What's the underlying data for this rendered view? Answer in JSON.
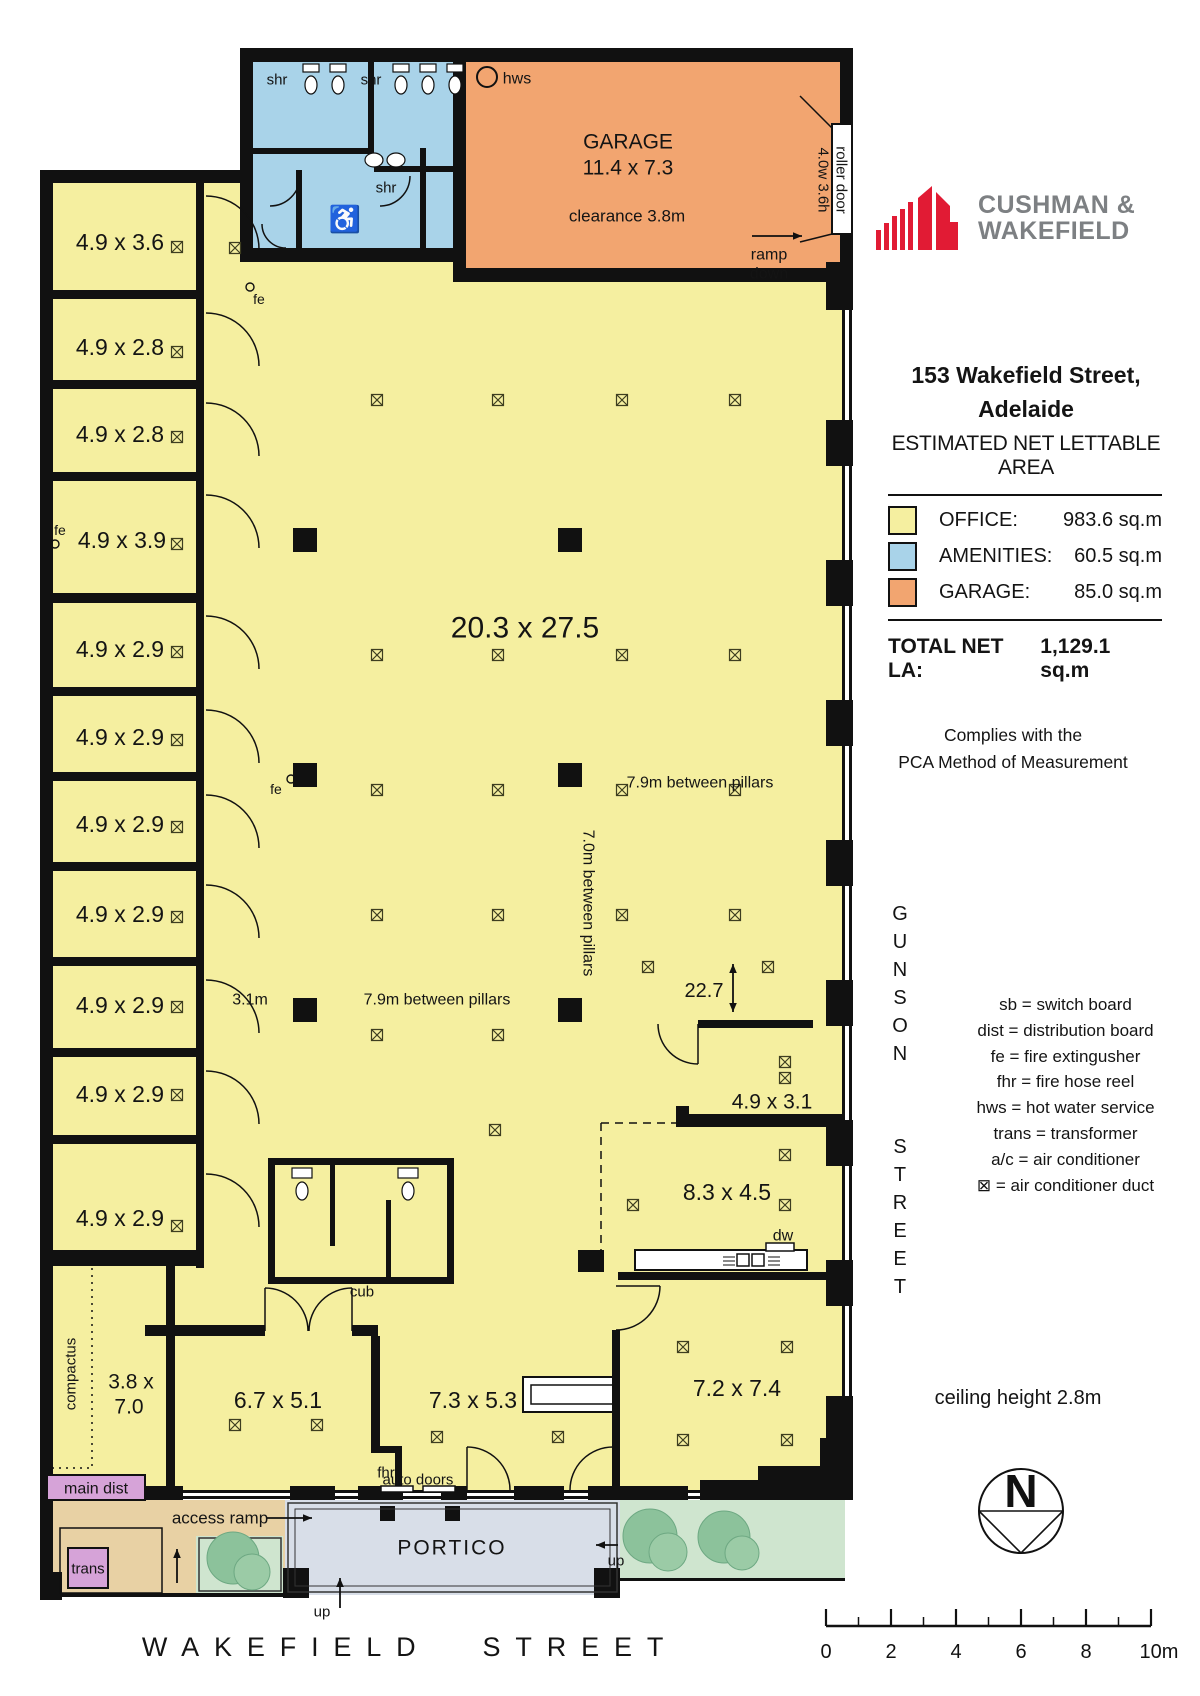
{
  "brand": {
    "line1": "CUSHMAN &",
    "line2": "WAKEFIELD",
    "red": "#e11b34",
    "gray": "#7d8083"
  },
  "panel": {
    "address1": "153 Wakefield Street,",
    "address2": "Adelaide",
    "subtitle": "ESTIMATED NET LETTABLE AREA",
    "legend": {
      "rows": [
        {
          "label": "OFFICE:",
          "value": "983.6 sq.m",
          "color": "#f5efa0"
        },
        {
          "label": "AMENITIES:",
          "value": "60.5 sq.m",
          "color": "#a9d3e9"
        },
        {
          "label": "GARAGE:",
          "value": "85.0 sq.m",
          "color": "#f2a570"
        }
      ],
      "total_label": "TOTAL NET LA:",
      "total_value": "1,129.1 sq.m"
    },
    "compliance1": "Complies with the",
    "compliance2": "PCA Method of Measurement",
    "abbreviations": [
      "sb = switch board",
      "dist = distribution board",
      "fe = fire extingusher",
      "fhr = fire hose reel",
      "hws = hot water service",
      "trans = transformer",
      "a/c = air conditioner",
      "⊠ = air conditioner duct"
    ],
    "ceiling_note": "ceiling height 2.8m",
    "north_letter": "N",
    "scalebar": {
      "labels": [
        "0",
        "2",
        "4",
        "6",
        "8",
        "10m"
      ]
    }
  },
  "streets": {
    "side1": "GUNSON",
    "side2": "STREET",
    "bottom": "WAKEFIELD STREET"
  },
  "plan": {
    "rects": [
      [
        52,
        182,
        793,
        1308,
        "#f5efa0"
      ],
      [
        252,
        60,
        201,
        195,
        "#a9d3e9"
      ],
      [
        465,
        62,
        375,
        208,
        "#f2a570"
      ],
      [
        52,
        1500,
        233,
        93,
        "#e8d1a4"
      ],
      [
        196,
        1536,
        87,
        57,
        "#cfe5cf"
      ],
      [
        285,
        1500,
        335,
        95,
        "#d8dee8"
      ],
      [
        620,
        1500,
        225,
        80,
        "#cfe5cf"
      ],
      [
        240,
        48,
        613,
        14
      ],
      [
        240,
        48,
        13,
        214
      ],
      [
        40,
        170,
        213,
        13
      ],
      [
        40,
        170,
        13,
        1427
      ],
      [
        240,
        248,
        226,
        14
      ],
      [
        453,
        48,
        13,
        234
      ],
      [
        453,
        268,
        400,
        14
      ],
      [
        196,
        182,
        8,
        1086
      ],
      [
        40,
        290,
        164,
        9
      ],
      [
        40,
        380,
        164,
        9
      ],
      [
        40,
        472,
        164,
        9
      ],
      [
        40,
        593,
        164,
        10
      ],
      [
        40,
        687,
        164,
        9
      ],
      [
        40,
        772,
        164,
        9
      ],
      [
        40,
        862,
        164,
        9
      ],
      [
        40,
        957,
        164,
        9
      ],
      [
        40,
        1048,
        164,
        9
      ],
      [
        40,
        1135,
        164,
        9
      ],
      [
        40,
        1250,
        164,
        16
      ],
      [
        166,
        1262,
        9,
        230
      ],
      [
        145,
        1325,
        120,
        11
      ],
      [
        352,
        1325,
        26,
        11
      ],
      [
        371,
        1336,
        9,
        116
      ],
      [
        371,
        1446,
        30,
        7
      ],
      [
        395,
        1446,
        7,
        46
      ],
      [
        612,
        1330,
        8,
        162
      ],
      [
        618,
        1272,
        227,
        8
      ],
      [
        578,
        1250,
        26,
        22
      ],
      [
        698,
        1020,
        115,
        8
      ],
      [
        676,
        1114,
        169,
        13
      ],
      [
        676,
        1106,
        13,
        21
      ],
      [
        268,
        1158,
        186,
        7
      ],
      [
        268,
        1277,
        186,
        7
      ],
      [
        268,
        1158,
        7,
        126
      ],
      [
        447,
        1158,
        7,
        126
      ],
      [
        330,
        1158,
        5,
        88
      ],
      [
        386,
        1200,
        5,
        84
      ],
      [
        368,
        60,
        6,
        94
      ],
      [
        252,
        148,
        116,
        6
      ],
      [
        374,
        166,
        79,
        6
      ],
      [
        296,
        170,
        6,
        85
      ],
      [
        420,
        148,
        6,
        100
      ],
      [
        840,
        62,
        13,
        64
      ],
      [
        840,
        230,
        13,
        52
      ],
      [
        842,
        262,
        3,
        1236
      ],
      [
        849,
        262,
        3,
        1236
      ],
      [
        826,
        262,
        27,
        48
      ],
      [
        826,
        420,
        27,
        46
      ],
      [
        826,
        560,
        27,
        46
      ],
      [
        826,
        700,
        27,
        46
      ],
      [
        826,
        840,
        27,
        46
      ],
      [
        826,
        980,
        27,
        46
      ],
      [
        826,
        1120,
        27,
        46
      ],
      [
        826,
        1260,
        27,
        46
      ],
      [
        826,
        1396,
        27,
        46
      ],
      [
        820,
        1438,
        33,
        62
      ],
      [
        150,
        1490,
        695,
        3
      ],
      [
        150,
        1496,
        695,
        3
      ],
      [
        145,
        1486,
        38,
        14
      ],
      [
        290,
        1486,
        45,
        14
      ],
      [
        358,
        1486,
        45,
        14
      ],
      [
        441,
        1486,
        26,
        14
      ],
      [
        514,
        1486,
        50,
        14
      ],
      [
        588,
        1486,
        100,
        14
      ],
      [
        700,
        1480,
        62,
        20
      ],
      [
        758,
        1466,
        87,
        34
      ],
      [
        40,
        1572,
        22,
        28
      ],
      [
        283,
        1568,
        26,
        30
      ],
      [
        594,
        1568,
        26,
        30
      ],
      [
        380,
        1506,
        15,
        15
      ],
      [
        445,
        1506,
        15,
        15
      ],
      [
        40,
        1593,
        250,
        4
      ],
      [
        620,
        1578,
        225,
        3
      ],
      [
        832,
        124,
        20,
        110,
        "#fff",
        "#111",
        2
      ],
      [
        635,
        1250,
        172,
        20,
        "#fff",
        "#111",
        2
      ],
      [
        523,
        1377,
        90,
        35,
        "#fff",
        "#111",
        2
      ],
      [
        531,
        1385,
        82,
        19,
        "none",
        "#111",
        1.5
      ],
      [
        766,
        1243,
        28,
        8,
        "#fff",
        "#111",
        1.5
      ],
      [
        737,
        1254,
        12,
        12,
        "#fff",
        "#111",
        1.5
      ],
      [
        752,
        1254,
        12,
        12,
        "#fff",
        "#111",
        1.5
      ],
      [
        47,
        1475,
        98,
        25,
        "#d6a3d8",
        "#111",
        2
      ],
      [
        60,
        1528,
        102,
        65,
        "none",
        "#111",
        1.5
      ],
      [
        68,
        1548,
        40,
        40,
        "#d6a3d8",
        "#111",
        2
      ],
      [
        288,
        1503,
        329,
        89,
        "none",
        "#333",
        1.5
      ],
      [
        295,
        1509,
        315,
        77,
        "none",
        "#333",
        1
      ],
      [
        199,
        1538,
        82,
        53,
        "none",
        "#333",
        1.5
      ],
      [
        381,
        1486,
        32,
        6,
        "#fff",
        "#111",
        1.5
      ],
      [
        423,
        1486,
        32,
        6,
        "#fff",
        "#111",
        1.5
      ],
      [
        303,
        64,
        16,
        8,
        "#fff",
        "#111",
        1.2
      ],
      [
        330,
        64,
        16,
        8,
        "#fff",
        "#111",
        1.2
      ],
      [
        393,
        64,
        16,
        8,
        "#fff",
        "#111",
        1.2
      ],
      [
        420,
        64,
        16,
        8,
        "#fff",
        "#111",
        1.2
      ],
      [
        447,
        64,
        16,
        8,
        "#fff",
        "#111",
        1.2
      ],
      [
        292,
        1168,
        20,
        10,
        "#fff",
        "#111",
        1.2
      ],
      [
        398,
        1168,
        20,
        10,
        "#fff",
        "#111",
        1.2
      ]
    ],
    "paths": [
      [
        "M92,1268 V1468",
        "2,5"
      ],
      [
        "M52,1468 H92",
        "2,5"
      ],
      [
        "M601,1123 V1263",
        "8,6"
      ],
      [
        "M601,1123 H683",
        "8,6"
      ],
      [
        "M206,196 A53,53 0 0 1 259,249"
      ],
      [
        "M206,313 A53,53 0 0 1 259,366"
      ],
      [
        "M206,403 A53,53 0 0 1 259,456"
      ],
      [
        "M206,495 A53,53 0 0 1 259,548"
      ],
      [
        "M206,616 A53,53 0 0 1 259,669"
      ],
      [
        "M206,710 A53,53 0 0 1 259,763"
      ],
      [
        "M206,795 A53,53 0 0 1 259,848"
      ],
      [
        "M206,885 A53,53 0 0 1 259,938"
      ],
      [
        "M206,980 A53,53 0 0 1 259,1033"
      ],
      [
        "M206,1071 A53,53 0 0 1 259,1124"
      ],
      [
        "M206,1174 A53,53 0 0 1 259,1227"
      ],
      [
        "M265,1288 A43,43 0 0 1 308,1331"
      ],
      [
        "M265,1288 V1331"
      ],
      [
        "M352,1288 A43,43 0 0 0 309,1331"
      ],
      [
        "M352,1288 V1331"
      ],
      [
        "M660,1286 A44,44 0 0 1 616,1330"
      ],
      [
        "M616,1286 H660"
      ],
      [
        "M698,1064 A40,40 0 0 1 658,1024"
      ],
      [
        "M698,1024 V1064"
      ],
      [
        "M467,1447 A43,43 0 0 1 510,1490"
      ],
      [
        "M467,1447 V1490"
      ],
      [
        "M613,1447 A43,43 0 0 0 570,1490"
      ],
      [
        "M613,1447 V1490"
      ],
      [
        "M800,96 L832,128"
      ],
      [
        "M800,242 L832,234"
      ],
      [
        "M723,1257 H735",
        null,
        1
      ],
      [
        "M723,1261 H735",
        null,
        1
      ],
      [
        "M723,1265 H735",
        null,
        1
      ],
      [
        "M768,1257 H780",
        null,
        1
      ],
      [
        "M768,1261 H780",
        null,
        1
      ],
      [
        "M768,1265 H780",
        null,
        1
      ],
      [
        "M300,176 A30,30 0 0 1 270,206"
      ],
      [
        "M410,176 A30,30 0 0 1 380,206"
      ],
      [
        "M262,224 A24,24 0 0 0 286,248"
      ]
    ],
    "circles": [
      [
        487,
        77,
        10,
        "none",
        "#111",
        2
      ],
      [
        250,
        287,
        4,
        "none",
        "#111",
        1.4
      ],
      [
        55,
        544,
        4,
        "none",
        "#111",
        1.4
      ],
      [
        291,
        779,
        4,
        "none",
        "#111",
        1.4
      ],
      [
        233,
        1558,
        26,
        "#8cc29b",
        "#6da882",
        1
      ],
      [
        252,
        1572,
        18,
        "#9bcba6",
        "#6da882",
        1
      ],
      [
        650,
        1536,
        27,
        "#8cc29b",
        "#6da882",
        1
      ],
      [
        668,
        1552,
        19,
        "#9bcba6",
        "#6da882",
        1
      ],
      [
        724,
        1537,
        26,
        "#8cc29b",
        "#6da882",
        1
      ],
      [
        742,
        1553,
        17,
        "#9bcba6",
        "#6da882",
        1
      ]
    ],
    "ellipses": [
      [
        311,
        85,
        6,
        9
      ],
      [
        338,
        85,
        6,
        9
      ],
      [
        401,
        85,
        6,
        9
      ],
      [
        428,
        85,
        6,
        9
      ],
      [
        455,
        85,
        6,
        9
      ],
      [
        374,
        160,
        9,
        7
      ],
      [
        396,
        160,
        9,
        7
      ],
      [
        302,
        1191,
        6,
        9
      ],
      [
        408,
        1191,
        6,
        9
      ]
    ],
    "pillars": [
      [
        305,
        540
      ],
      [
        570,
        540
      ],
      [
        305,
        775
      ],
      [
        570,
        775
      ],
      [
        305,
        1010
      ],
      [
        570,
        1010
      ]
    ],
    "ducts": [
      [
        377,
        400
      ],
      [
        498,
        400
      ],
      [
        622,
        400
      ],
      [
        735,
        400
      ],
      [
        377,
        655
      ],
      [
        498,
        655
      ],
      [
        622,
        655
      ],
      [
        735,
        655
      ],
      [
        377,
        790
      ],
      [
        498,
        790
      ],
      [
        622,
        790
      ],
      [
        735,
        790
      ],
      [
        377,
        915
      ],
      [
        498,
        915
      ],
      [
        622,
        915
      ],
      [
        735,
        915
      ],
      [
        377,
        1035
      ],
      [
        498,
        1035
      ],
      [
        495,
        1130
      ],
      [
        235,
        248
      ],
      [
        177,
        247
      ],
      [
        177,
        352
      ],
      [
        177,
        437
      ],
      [
        177,
        544
      ],
      [
        177,
        652
      ],
      [
        177,
        740
      ],
      [
        177,
        827
      ],
      [
        177,
        917
      ],
      [
        177,
        1007
      ],
      [
        177,
        1095
      ],
      [
        177,
        1226
      ],
      [
        648,
        967
      ],
      [
        768,
        967
      ],
      [
        785,
        1062
      ],
      [
        785,
        1078
      ],
      [
        633,
        1205
      ],
      [
        785,
        1155
      ],
      [
        785,
        1205
      ],
      [
        683,
        1347
      ],
      [
        787,
        1347
      ],
      [
        683,
        1440
      ],
      [
        787,
        1440
      ],
      [
        437,
        1437
      ],
      [
        558,
        1437
      ],
      [
        235,
        1425
      ],
      [
        317,
        1425
      ]
    ],
    "arrows": [
      [
        752,
        236,
        802,
        236,
        0
      ],
      [
        266,
        1518,
        312,
        1518,
        0
      ],
      [
        177,
        1583,
        177,
        1549,
        0
      ],
      [
        340,
        1608,
        340,
        1578,
        0
      ],
      [
        618,
        1545,
        596,
        1545,
        0
      ],
      [
        733,
        964,
        733,
        1012,
        1
      ]
    ],
    "labels": [
      [
        "shr",
        277,
        80,
        15
      ],
      [
        "shr",
        371,
        80,
        15
      ],
      [
        "shr",
        386,
        188,
        15
      ],
      [
        "hws",
        517,
        79,
        16
      ],
      [
        "GARAGE",
        628,
        142,
        21
      ],
      [
        "11.4 x 7.3",
        628,
        168,
        21
      ],
      [
        "clearance 3.8m",
        627,
        216,
        17
      ],
      [
        "roller door",
        841,
        180,
        15,
        90
      ],
      [
        "4.0w 3.6h",
        823,
        180,
        15,
        90
      ],
      [
        "ramp",
        769,
        255,
        16
      ],
      [
        "down",
        769,
        274,
        16
      ],
      [
        "fe",
        259,
        299,
        14
      ],
      [
        "fe",
        60,
        530,
        14
      ],
      [
        "fe",
        276,
        789,
        14
      ],
      [
        "4.9 x 3.6",
        120,
        242,
        23
      ],
      [
        "4.9 x 2.8",
        120,
        347,
        23
      ],
      [
        "4.9 x 2.8",
        120,
        434,
        23
      ],
      [
        "4.9 x 3.9",
        122,
        540,
        23
      ],
      [
        "4.9 x 2.9",
        120,
        649,
        23
      ],
      [
        "4.9 x 2.9",
        120,
        737,
        23
      ],
      [
        "4.9 x 2.9",
        120,
        824,
        23
      ],
      [
        "4.9 x 2.9",
        120,
        914,
        23
      ],
      [
        "4.9 x 2.9",
        120,
        1005,
        23
      ],
      [
        "4.9 x 2.9",
        120,
        1094,
        23
      ],
      [
        "4.9 x 2.9",
        120,
        1218,
        23
      ],
      [
        "20.3 x 27.5",
        525,
        628,
        30
      ],
      [
        "7.9m between pillars",
        700,
        783,
        16
      ],
      [
        "7.0m between pillars",
        588,
        903,
        16,
        90
      ],
      [
        "7.9m between pillars",
        437,
        1000,
        16
      ],
      [
        "3.1m",
        250,
        1000,
        16
      ],
      [
        "22.7",
        704,
        991,
        20
      ],
      [
        "4.9 x 3.1",
        772,
        1102,
        21
      ],
      [
        "8.3 x 4.5",
        727,
        1192,
        23
      ],
      [
        "dw",
        783,
        1236,
        16
      ],
      [
        "cub",
        362,
        1292,
        15
      ],
      [
        "compactus",
        71,
        1374,
        15,
        -90
      ],
      [
        "3.8 x",
        131,
        1382,
        21
      ],
      [
        "7.0",
        129,
        1407,
        21
      ],
      [
        "6.7 x 5.1",
        278,
        1400,
        23
      ],
      [
        "7.3 x 5.3",
        473,
        1400,
        23
      ],
      [
        "7.2 x 7.4",
        737,
        1388,
        23
      ],
      [
        "main dist",
        96,
        1489,
        16
      ],
      [
        "trans",
        88,
        1569,
        15
      ],
      [
        "access ramp",
        220,
        1518,
        17
      ],
      [
        "fhr",
        386,
        1473,
        15
      ],
      [
        "auto doors",
        418,
        1480,
        15
      ],
      [
        "PORTICO",
        452,
        1548,
        21,
        0,
        2
      ],
      [
        "up",
        322,
        1612,
        15
      ],
      [
        "up",
        616,
        1561,
        15
      ],
      [
        "♿",
        345,
        219,
        26
      ]
    ]
  }
}
